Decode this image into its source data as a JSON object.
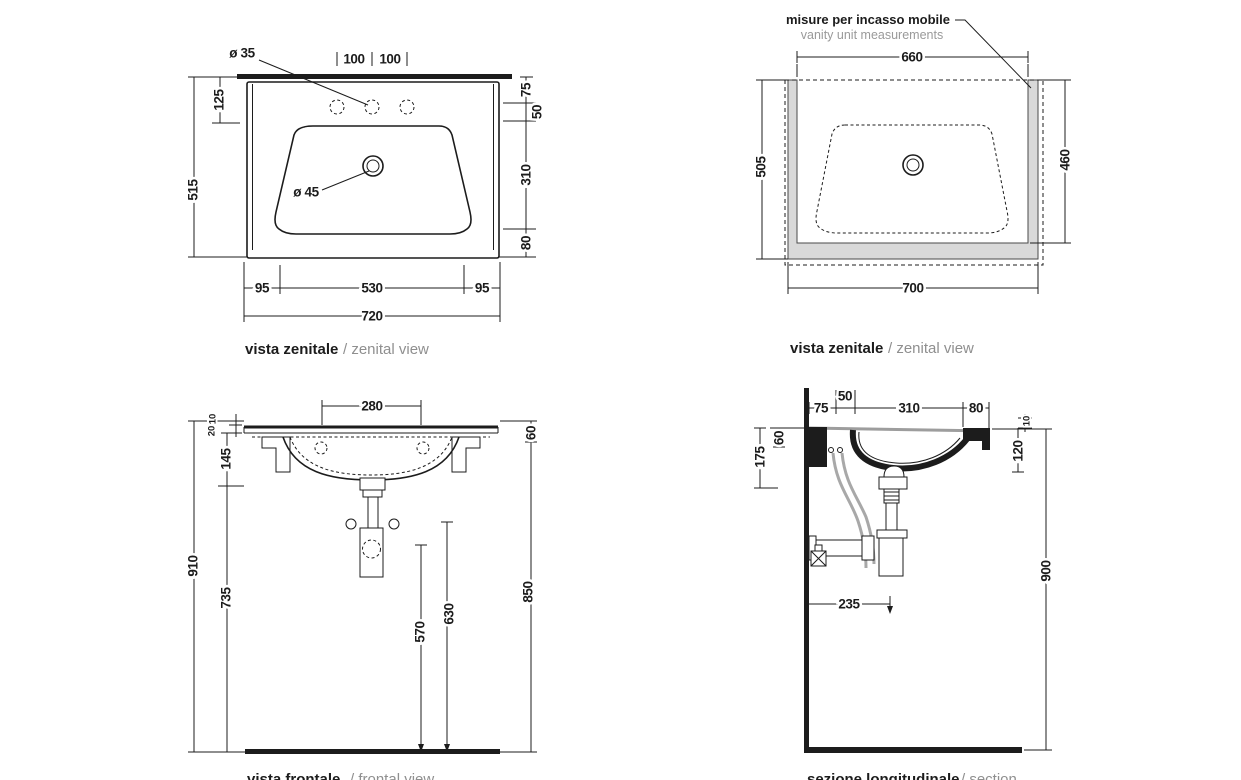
{
  "views": {
    "zenital": {
      "caption_bold": "vista zenitale",
      "caption_light": "/ zenital view",
      "hole_diameter": "ø 35",
      "drain_diameter": "ø 45",
      "hole_pitch_a": "100",
      "hole_pitch_b": "100",
      "rear_to_holes": "125",
      "total_depth": "515",
      "rear_edge": "75",
      "to_basin": "50",
      "basin_depth": "310",
      "front_edge": "80",
      "margin_left": "95",
      "basin_width": "530",
      "margin_right": "95",
      "total_width": "720"
    },
    "vanity": {
      "note_bold": "misure per incasso mobile",
      "note_light": "vanity unit measurements",
      "caption_bold": "vista zenitale",
      "caption_light": "/ zenital view",
      "inner_width": "660",
      "total_depth": "505",
      "inner_depth": "460",
      "total_width": "700"
    },
    "frontal": {
      "caption_bold": "vista frontale",
      "caption_light": "/ frontal view",
      "fixing_pitch": "280",
      "top_lip": "10",
      "slab_thickness": "20",
      "basin_depth": "145",
      "total_height": "910",
      "clearance": "735",
      "slab_front": "60",
      "rim_height": "850",
      "trap_height": "570",
      "fixings_height": "630"
    },
    "section": {
      "caption_bold": "sezione longitudinale",
      "caption_light": "/ section",
      "wall_to_holes": "75",
      "holes_width": "50",
      "basin_inner": "310",
      "front_lip": "80",
      "rear_drop": "60",
      "bracket_drop": "175",
      "lip_thickness": "10",
      "front_height": "120",
      "trap_offset": "235",
      "rim_height": "900"
    }
  },
  "colors": {
    "line": "#1c1c1c",
    "light_text": "#8f8f8f",
    "vanity_fill": "#d9d9d9",
    "hose": "#a8a8a8",
    "background": "#ffffff"
  }
}
